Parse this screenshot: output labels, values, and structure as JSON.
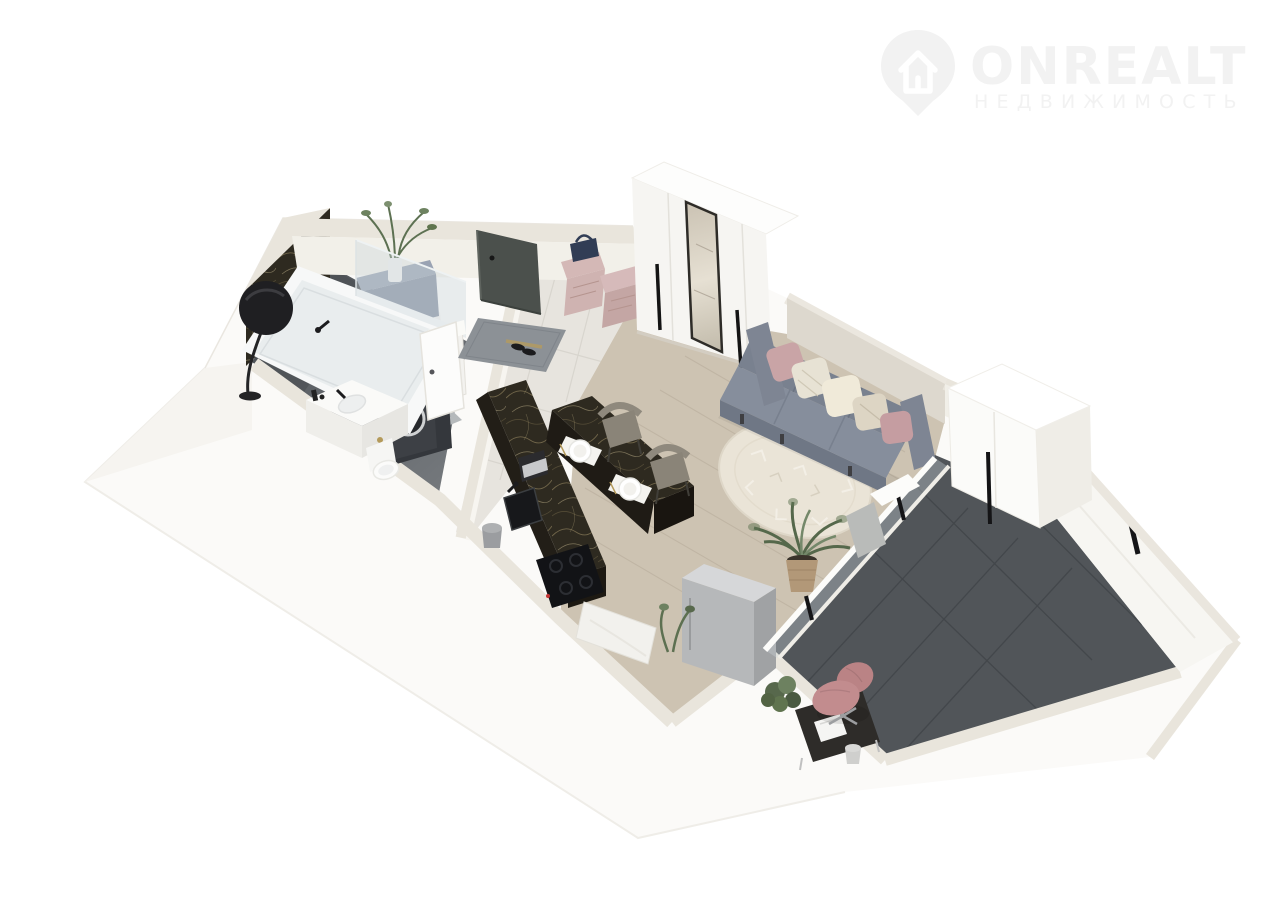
{
  "watermark": {
    "brand": "ONREALT",
    "tagline": "НЕДВИЖИМОСТЬ",
    "icon": "house-location-pin-icon",
    "color": "#f2f2f2"
  },
  "scene": {
    "title": "3D floor plan of a studio apartment",
    "view": "axonometric top-down 3D render",
    "background": "#ffffff"
  },
  "palette": {
    "wall_top": "#e9e5dc",
    "wall_face": "#f2f0e9",
    "wall_bright": "#fbfaf8",
    "marble": "#2e2a20",
    "marble_vein": "#8d7f5c",
    "bath_floor": "#6a6e72",
    "tile": "#e7e4de",
    "wood": "#cdc3b2",
    "dark_floor": "#515559",
    "sofa": "#7e8593",
    "rug": "#eae4d7",
    "pouf_pink": "#cfb3b1",
    "chair_pink": "#c28c8e",
    "blue_gray": "#8791a2",
    "fridge_gray": "#b6b8ba",
    "watermark": "#f2f2f2"
  },
  "rooms": [
    {
      "name": "bathroom",
      "floor": "dark-gray",
      "features": [
        "marble accent wall",
        "bathtub with glass screen",
        "black disc lamp",
        "washing machine in dark niche",
        "white drawer unit",
        "blue-gray cabinet with plant",
        "vanity sink with black faucet",
        "toilet",
        "striped bath mat",
        "laundry basket",
        "white door"
      ]
    },
    {
      "name": "entry-hall",
      "floor": "light-tile",
      "features": [
        "dark entry door",
        "gray doormat",
        "black shoes",
        "two pink tufted ottomans",
        "navy bag",
        "white wardrobe with mirror and black handles"
      ]
    },
    {
      "name": "kitchen",
      "floor": "wood",
      "features": [
        "L-shaped dark marble counter",
        "black sink",
        "coffee machine",
        "black induction cooktop",
        "breakfast bar with two place settings",
        "two taupe chairs",
        "gray fridge column",
        "white base cabinet",
        "small bin",
        "plant"
      ]
    },
    {
      "name": "living-room",
      "floor": "wood",
      "features": [
        "gray three-seat sofa",
        "five pillows",
        "round cream rug with geometric pattern",
        "potted plant in woven basket",
        "window wall to loggia"
      ]
    },
    {
      "name": "loggia",
      "floor": "dark-charcoal-tile",
      "features": [
        "tall white wardrobe with black handle",
        "glazed windows with black handles",
        "dark desk",
        "white laptop",
        "pink office chair",
        "plants",
        "small waste bin"
      ]
    }
  ]
}
